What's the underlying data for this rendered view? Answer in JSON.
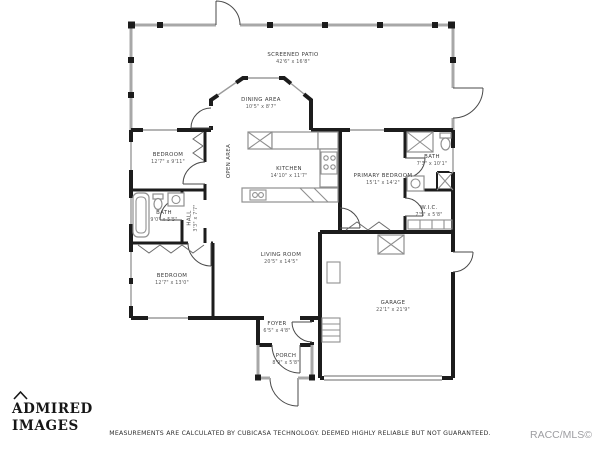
{
  "colors": {
    "wall": "#1c1c1c",
    "patio_wall": "#a8a8a8",
    "label": "#3b3b3b",
    "watermark": "#9d9da1"
  },
  "rooms": [
    {
      "name": "SCREENED PATIO",
      "dims": "42'6\" x 16'8\""
    },
    {
      "name": "DINING AREA",
      "dims": "10'5\" x 8'7\""
    },
    {
      "name": "BEDROOM",
      "dims": "12'7\" x 9'11\""
    },
    {
      "name": "BATH",
      "dims": "9'0\" x 5'5\""
    },
    {
      "name": "HALL",
      "dims": "3'3\" x 7'7\""
    },
    {
      "name": "OPEN AREA",
      "dims": ""
    },
    {
      "name": "BEDROOM",
      "dims": "12'7\" x 13'0\""
    },
    {
      "name": "KITCHEN",
      "dims": "14'10\" x 11'7\""
    },
    {
      "name": "LIVING ROOM",
      "dims": "20'5\" x 14'5\""
    },
    {
      "name": "PRIMARY BEDROOM",
      "dims": "15'1\" x 14'2\""
    },
    {
      "name": "BATH",
      "dims": "7'3\" x 10'1\""
    },
    {
      "name": "W.I.C.",
      "dims": "7'5\" x 5'8\""
    },
    {
      "name": "GARAGE",
      "dims": "22'1\" x 21'9\""
    },
    {
      "name": "FOYER",
      "dims": "6'5\" x 4'8\""
    },
    {
      "name": "PORCH",
      "dims": "8'9\" x 5'8\""
    }
  ],
  "footer": {
    "disclaimer": "MEASUREMENTS ARE CALCULATED BY CUBICASA TECHNOLOGY. DEEMED HIGHLY RELIABLE BUT NOT GUARANTEED.",
    "watermark": "RACC/MLS©"
  },
  "logo": {
    "line1": "ADMIRED",
    "line2": "IMAGES"
  }
}
